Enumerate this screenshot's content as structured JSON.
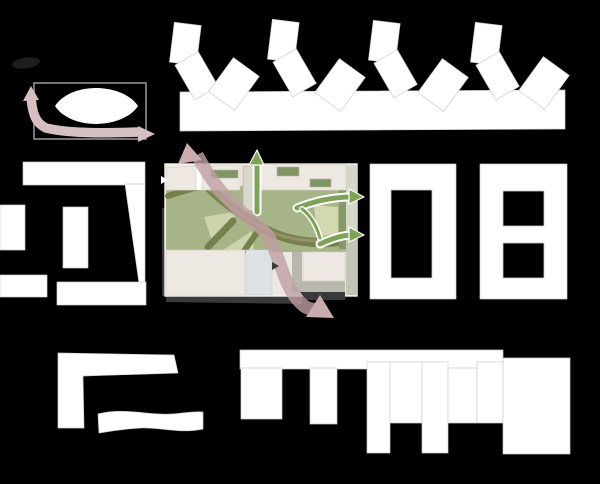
{
  "canvas": {
    "width": 600,
    "height": 484
  },
  "colors": {
    "background": "#000000",
    "building_white": "#ffffff",
    "outline_gray": "#cdcdcd",
    "frame_gray": "#9a9a9a",
    "blob_dark": "#1d1d1d",
    "arrow_pink_light": "#d6bfc0",
    "arrow_pink": "#bf9fa3",
    "arrow_pink_head": "#cbacae",
    "arrow_green": "#7ca356",
    "site_cream": "#ede8e1",
    "site_cream_line": "#d9d3c9",
    "plan_border": "#f7f4ee",
    "lawn_green": "#a6b488",
    "lawn_pale": "#cbd4ac",
    "panel_pale": "#d3d8af",
    "path_olive": "#75814b",
    "path_tan": "#97906a",
    "roof_green": "#7f9564",
    "hedge_green": "#87996a",
    "promenade_gray": "#d9d6cc",
    "promenade_line": "#b7b4aa",
    "plaza_blue": "#dce2e6",
    "path_gray": "#b8b8af",
    "shadow_dark": "#3a3a3a",
    "marker_dark": "#3a3a3a"
  },
  "diagram": {
    "type": "urban-design site diagram",
    "site_plan": {
      "green_flow_arrows": [
        "north",
        "east-upper",
        "east-lower"
      ],
      "pink_flow_arrow": "northwest-to-southeast through site",
      "ground_elements": [
        "lawn",
        "organic path network",
        "central promenade",
        "plaza",
        "courtyard buildings"
      ]
    },
    "concept_figure": {
      "shape": "white lens in rectangular frame",
      "pink_arrow": "up at left, then east along bottom"
    },
    "context_blocks": {
      "top_sawtooth_row": 9,
      "left_blocks": 6,
      "right_courtyard_blocks": 2,
      "bottom_blocks": 11
    }
  }
}
